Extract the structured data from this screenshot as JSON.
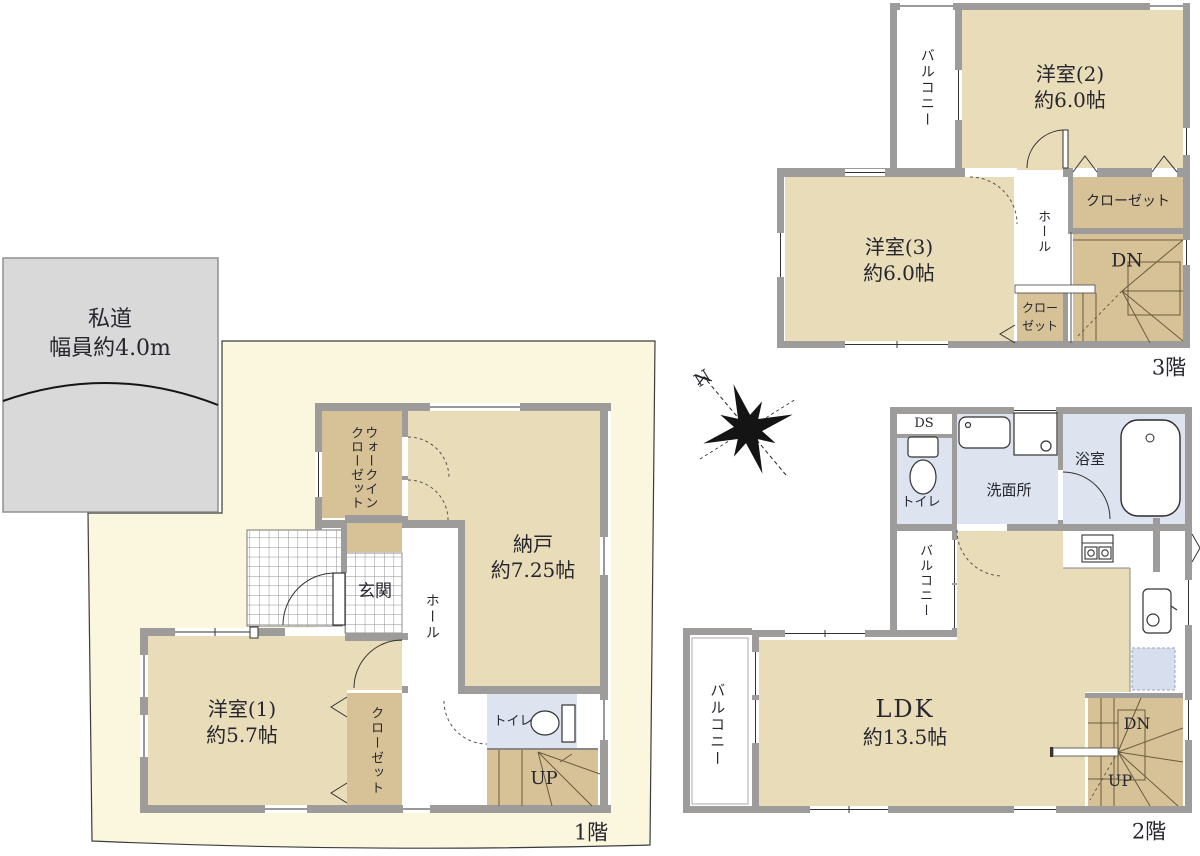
{
  "colors": {
    "lot_fill": "#faf7de",
    "road_fill": "#d9d9d9",
    "wall_gray": "#9e9c9a",
    "room_tan": "#e9dcb9",
    "closet_tan": "#d7c298",
    "wet_blue": "#dde3ef",
    "appliance_blue": "#d7dfee",
    "line_dark": "#2b2b2b"
  },
  "road": {
    "line1": "私道",
    "line2": "幅員約4.0m"
  },
  "compass": {
    "north": "N"
  },
  "floors": {
    "f1": {
      "label": "1階",
      "wic_line1": "ウォークイン",
      "wic_line2": "クローゼット",
      "storage_name": "納戸",
      "storage_size": "約7.25帖",
      "genkan": "玄関",
      "hall": "ホール",
      "bedroom_name": "洋室(1)",
      "bedroom_size": "約5.7帖",
      "closet": "クローゼット",
      "toilet": "トイレ",
      "stairs_up": "UP"
    },
    "f2": {
      "label": "2階",
      "ds": "DS",
      "toilet": "トイレ",
      "washroom": "洗面所",
      "bathroom": "浴室",
      "balcony_small": "バルコニー",
      "balcony_large": "バルコニー",
      "ldk_name": "LDK",
      "ldk_size": "約13.5帖",
      "stairs_down": "DN",
      "stairs_up": "UP"
    },
    "f3": {
      "label": "3階",
      "balcony": "バルコニー",
      "bedroom2_name": "洋室(2)",
      "bedroom2_size": "約6.0帖",
      "bedroom3_name": "洋室(3)",
      "bedroom3_size": "約6.0帖",
      "closet": "クローゼット",
      "closet2_line1": "クロー",
      "closet2_line2": "ゼット",
      "hall": "ホール",
      "stairs_down": "DN"
    }
  }
}
